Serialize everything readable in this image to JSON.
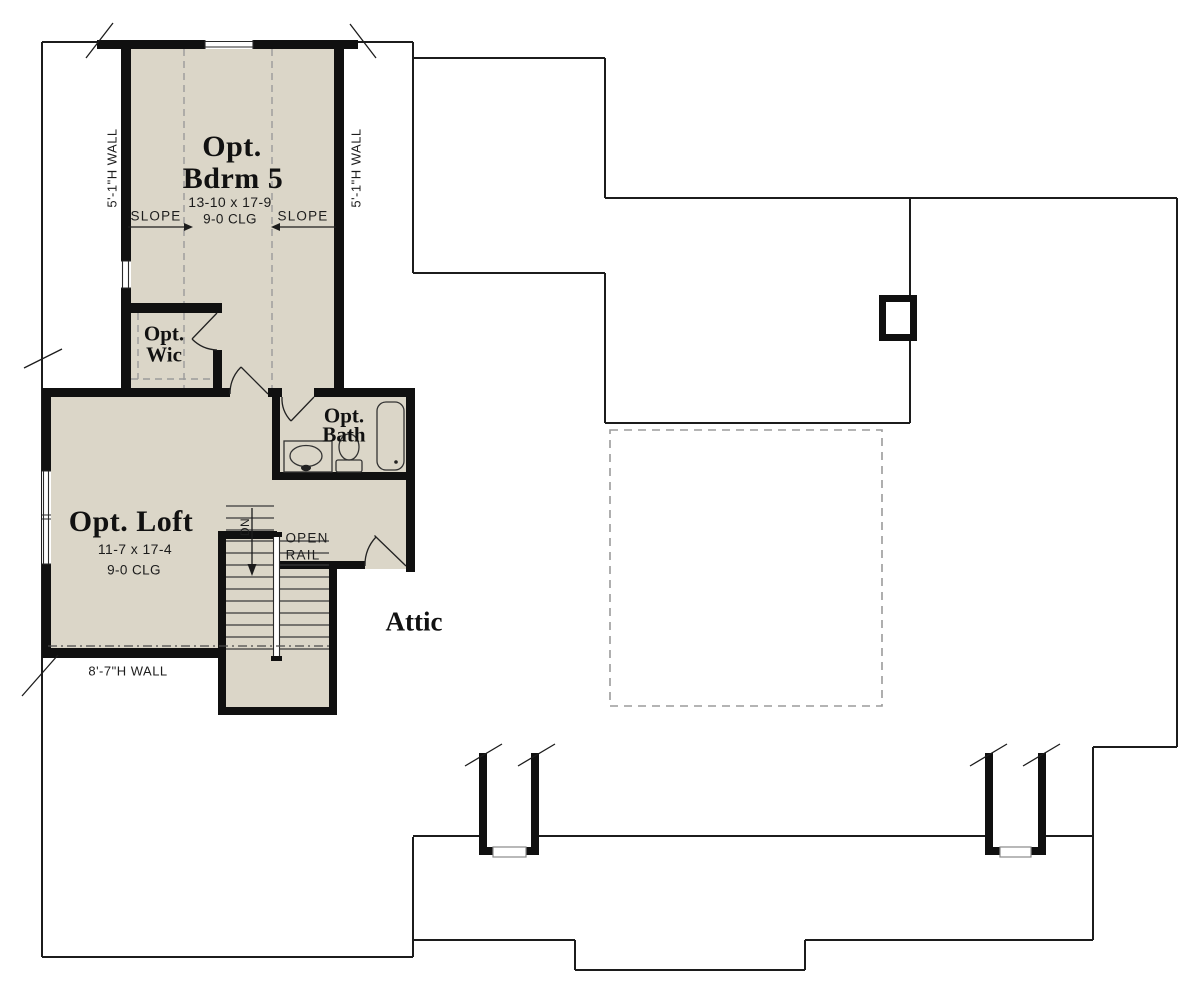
{
  "plan": {
    "bedroom": {
      "label_top": "Opt.",
      "label_bottom": "Bdrm 5",
      "dims": "13-10 x 17-9",
      "ceiling": "9-0 CLG",
      "slope_left": "SLOPE",
      "slope_right": "SLOPE",
      "wall_left": "5'-1\"H WALL",
      "wall_right": "5'-1\"H WALL"
    },
    "wic": {
      "label_top": "Opt.",
      "label_bottom": "Wic"
    },
    "bath": {
      "label_top": "Opt.",
      "label_bottom": "Bath"
    },
    "loft": {
      "label": "Opt. Loft",
      "dims": "11-7 x 17-4",
      "ceiling": "9-0 CLG",
      "wall_bottom": "8'-7\"H WALL"
    },
    "stairs": {
      "down": "DN",
      "rail_top": "OPEN",
      "rail_bottom": "RAIL"
    },
    "attic": {
      "label": "Attic"
    },
    "colors": {
      "floor": "#dbd6c8",
      "wall": "#101010",
      "line": "#1c1c1c",
      "dash": "#9b9b9b"
    }
  }
}
